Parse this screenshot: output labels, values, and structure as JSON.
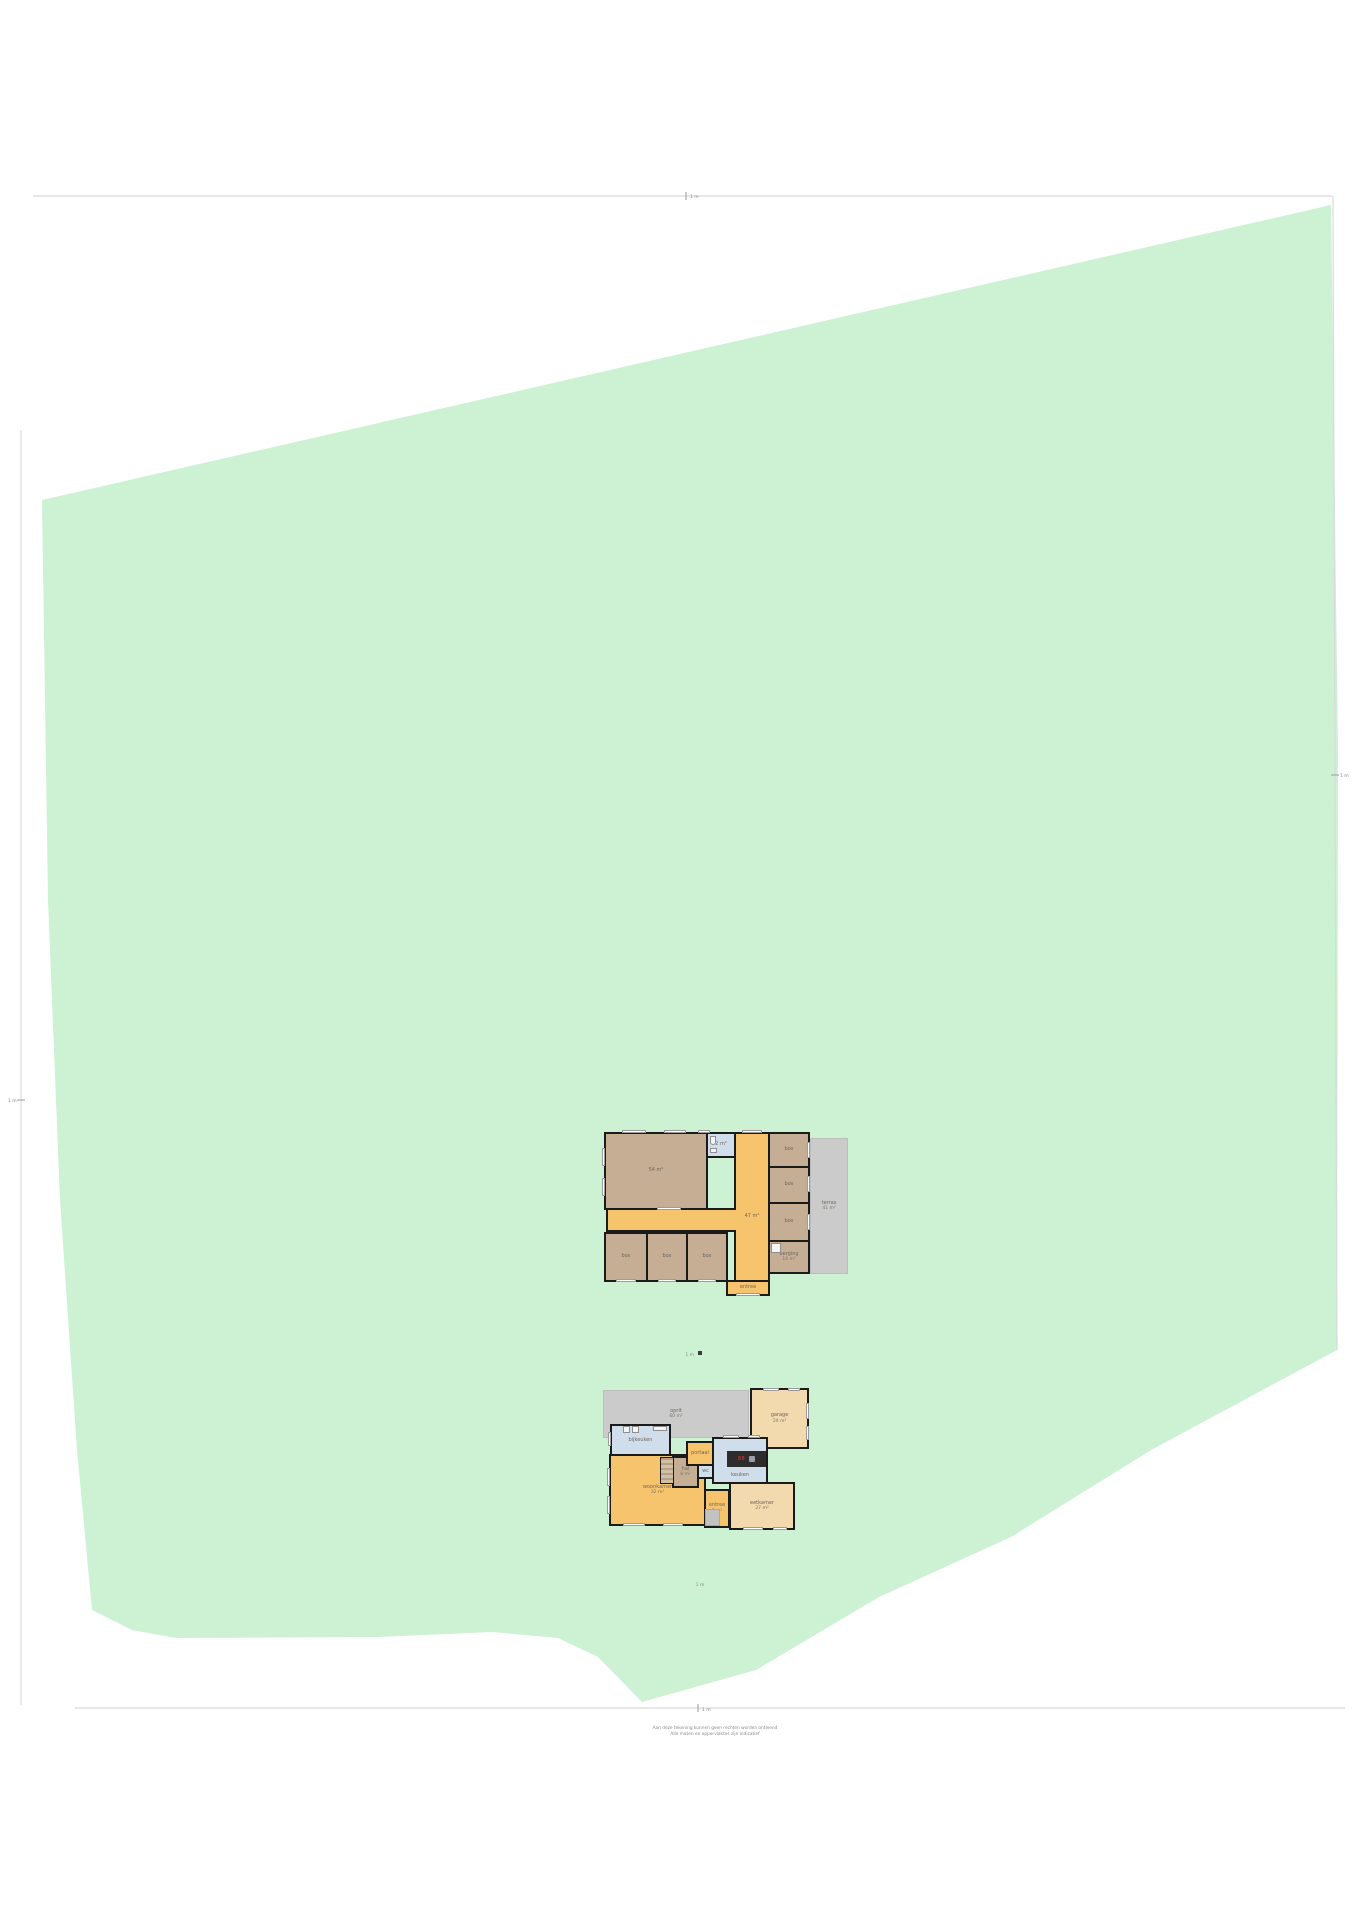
{
  "page": {
    "background": "#ffffff",
    "frame_color": "#dadada",
    "tick_color": "#9a9a9a"
  },
  "plot": {
    "fill": "#cdf1d3",
    "polygon": [
      [
        42,
        500
      ],
      [
        1331,
        205
      ],
      [
        1338,
        750
      ],
      [
        1337,
        1350
      ],
      [
        1151,
        1450
      ],
      [
        1011,
        1537
      ],
      [
        879,
        1597
      ],
      [
        756,
        1670
      ],
      [
        642,
        1702
      ],
      [
        598,
        1657
      ],
      [
        558,
        1638
      ],
      [
        492,
        1632
      ],
      [
        378,
        1637
      ],
      [
        176,
        1638
      ],
      [
        132,
        1630
      ],
      [
        92,
        1610
      ],
      [
        77,
        1450
      ],
      [
        60,
        1200
      ],
      [
        48,
        900
      ]
    ]
  },
  "edge_markers": {
    "top": "1 m",
    "right": "1 m",
    "left": "1 m",
    "bottom": "1 m"
  },
  "captions": {
    "plan1_scale": "1 m",
    "plan2_scale": "1 m",
    "disclaimer_line1": "Aan deze tekening kunnen geen rechten worden ontleend",
    "disclaimer_line2": "Alle maten en oppervlaktes zijn indicatief"
  },
  "plan1": {
    "name": "schuur",
    "rooms": {
      "stal_groot": "54 m²",
      "wc": "2 m²",
      "gang": "47 m²",
      "gang_onder": "entree",
      "box_r1": "box",
      "box_r2": "box",
      "box_r3": "box",
      "berging_l1": "berging",
      "berging_l2": "14 m²",
      "box_b1": "box",
      "box_b2": "box",
      "box_b3": "box",
      "terras_l1": "terras",
      "terras_l2": "41 m²"
    }
  },
  "plan2": {
    "name": "woonhuis",
    "rooms": {
      "oprit_l1": "oprit",
      "oprit_l2": "60 m²",
      "garage_l1": "garage",
      "garage_l2": "24 m²",
      "bijkeuken": "bijkeuken",
      "woonkamer_l1": "woonkamer",
      "woonkamer_l2": "32 m²",
      "hal_l1": "hal",
      "hal_l2": "8 m²",
      "portaal": "portaal",
      "wc": "wc",
      "keuken": "keuken",
      "island_display": "88",
      "eetkamer_l1": "eetkamer",
      "eetkamer_l2": "27 m²",
      "entree_l1": "entree",
      "entree_l2": "5 m²"
    }
  }
}
